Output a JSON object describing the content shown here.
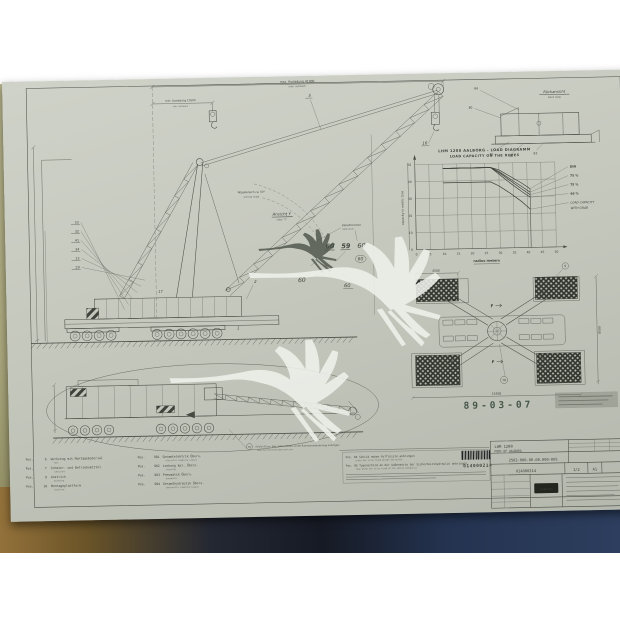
{
  "drawing": {
    "dims": {
      "max_l1": "max. Ausladung 41000",
      "max_l2": "max. outreach",
      "min_l1": "min. Ausladung 10500",
      "min_l2": "min. outreach",
      "luff_l1": "Wippbereich ca. 50°",
      "luff_l2": "working range"
    },
    "view_y": {
      "label": "Ansicht Y",
      "sub": "view \"Y\""
    },
    "cable": {
      "l1": "Kabeltrommel",
      "l2": "cable drum"
    },
    "rear": {
      "label": "Rückansicht",
      "sub": "back view",
      "callouts": [
        "84",
        "80",
        "81",
        "82",
        "83"
      ]
    },
    "callouts_left": [
      "33",
      "32",
      "41",
      "34",
      "13",
      "29"
    ],
    "callouts": {
      "c5": "5",
      "c16": "16",
      "c2": "2",
      "c1": "1",
      "c17": "17"
    },
    "numbers": [
      "60",
      "59",
      "60",
      "60",
      "60",
      "60"
    ],
    "stamp": "89-03-07",
    "plan": {
      "dim_top": "4500",
      "dim_right": "8500",
      "dim_bottom": "13408",
      "c9": "9",
      "c78": "78",
      "section": "F"
    },
    "transport": {
      "c75": "75",
      "note_l1": "Schild 'Kl.bar' über jedem Reifen an der Rahmenverbreiterung anbringen",
      "note_l2": "plate has to be fixed above each tyre"
    }
  },
  "parts": {
    "left": [
      {
        "num": "6",
        "label": "Werkzeug mit Montagematerial",
        "sub": "tool"
      },
      {
        "num": "7",
        "label": "Schmier- und Betriebsmittel",
        "sub": "lubricant"
      },
      {
        "num": "9",
        "label": "Anstrich",
        "sub": "painting"
      },
      {
        "num": "10",
        "label": "Montageplattform",
        "sub": "platform"
      }
    ],
    "right": [
      {
        "num": "901",
        "label": "Gesamtelektrik Übers.",
        "sub": "electrics complete layout"
      },
      {
        "num": "902",
        "label": "Lenkung kpl. Übers.",
        "sub": "steering"
      },
      {
        "num": "903",
        "label": "Pneumatik Übers.",
        "sub": "pneumatic"
      },
      {
        "num": "904",
        "label": "Gesamthydraulik Übers.",
        "sub": "hydraulics complete layout"
      }
    ]
  },
  "notes": {
    "n1": "Pos. 84  Schild neben Puffleiste anbringen",
    "n1_sub": "plate has to be fixed beside the buffer",
    "n2": "Pos. 85  Typenschild an der Außenseite der Sicherheitshydraulik anbringen",
    "n2_sub": "type plate has to be fixed at the safety hydraulics"
  },
  "barcode": {
    "value": "014000214"
  },
  "title_block": {
    "product": "LHM 1200",
    "project": "PORT OF AALBORG",
    "drawing_no": "2502-000.00.00.000-005",
    "doc_no": "014000214",
    "sheet": "1/2",
    "format": "A1",
    "logo": "LIEBHERR"
  },
  "chart_data": {
    "type": "line",
    "title1": "LHM 1200 AALBORG - LOAD DIAGRAMM",
    "title2": "LOAD CAPACITY ON THE ROPES",
    "xlabel": "radius meters",
    "ylabel": "capacity in metric tons",
    "xlim": [
      0,
      50
    ],
    "ylim": [
      0,
      50
    ],
    "xticks": [
      0,
      5,
      10,
      15,
      20,
      25,
      30,
      35,
      40,
      45,
      50
    ],
    "yticks": [
      0,
      10,
      20,
      30,
      40,
      50
    ],
    "grid": true,
    "legend_position": "right",
    "legend": [
      "DIN",
      "75 %",
      "75 %",
      "66 %"
    ],
    "legend_grab1": "LOAD  CAPACITY",
    "legend_grab2": "WITH  GRAB",
    "vline_x": 41,
    "series": [
      {
        "name": "DIN",
        "points": [
          [
            10,
            47.5
          ],
          [
            27,
            47.5
          ],
          [
            30,
            46
          ],
          [
            34,
            42
          ],
          [
            38,
            38
          ],
          [
            41,
            34.5
          ]
        ]
      },
      {
        "name": "75 %",
        "points": [
          [
            10,
            47.5
          ],
          [
            27,
            47.5
          ],
          [
            30,
            45
          ],
          [
            34,
            40.5
          ],
          [
            38,
            36
          ],
          [
            41,
            32.5
          ]
        ]
      },
      {
        "name": "75 %",
        "points": [
          [
            10,
            47.5
          ],
          [
            27,
            47.5
          ],
          [
            30,
            44.5
          ],
          [
            34,
            39.5
          ],
          [
            38,
            34.5
          ],
          [
            41,
            31
          ]
        ]
      },
      {
        "name": "66 %",
        "points": [
          [
            10,
            47.5
          ],
          [
            27,
            47.5
          ],
          [
            30,
            43.5
          ],
          [
            34,
            38
          ],
          [
            38,
            33
          ],
          [
            41,
            29.5
          ]
        ]
      },
      {
        "name": "grab",
        "points": [
          [
            10,
            39
          ],
          [
            27,
            39
          ],
          [
            30,
            36.5
          ],
          [
            34,
            32
          ],
          [
            38,
            27
          ],
          [
            41,
            22.5
          ]
        ]
      }
    ]
  }
}
